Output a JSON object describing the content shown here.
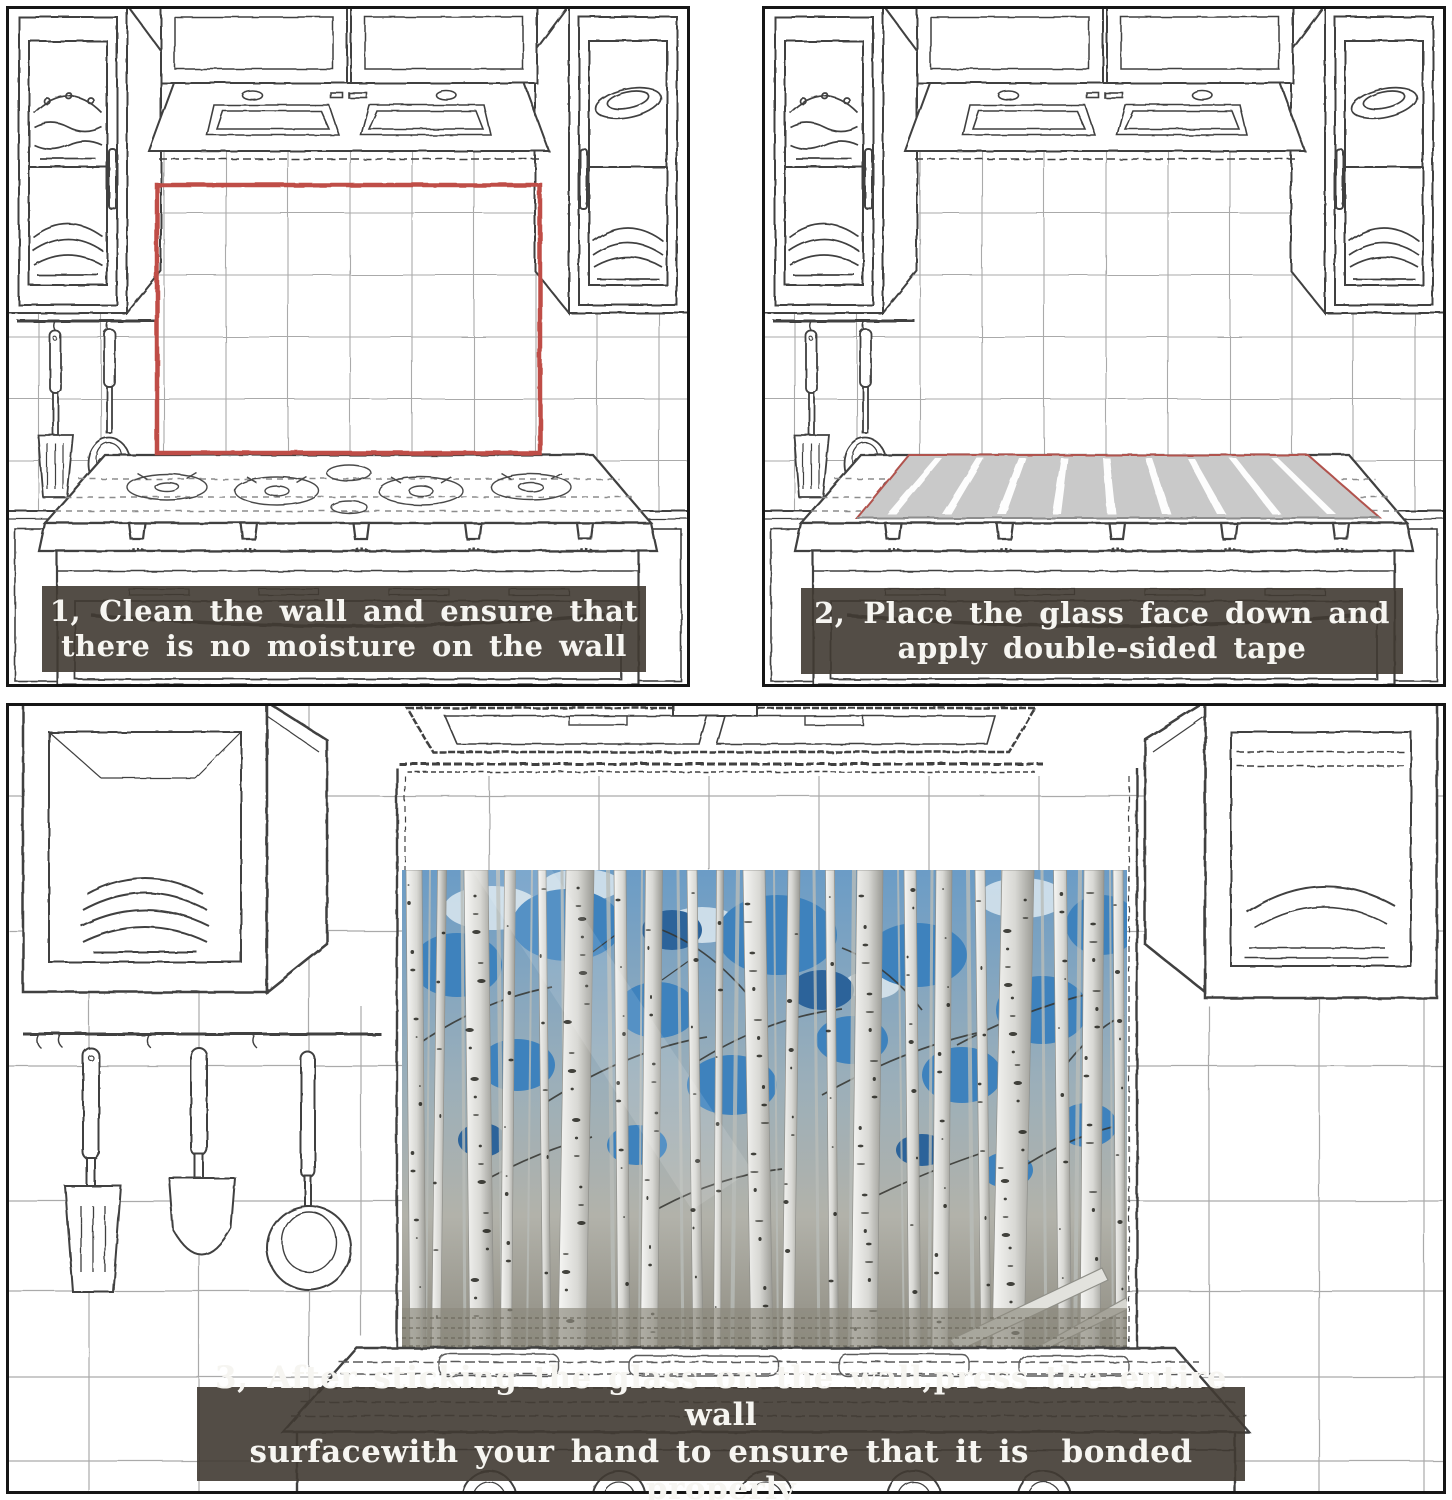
{
  "steps": [
    {
      "prefix": "1、",
      "line1": "Clean the wall and ensure that",
      "line2": "there is no moisture on the wall"
    },
    {
      "prefix": "2、",
      "line1": "Place the glass face down and",
      "line2": "apply double-sided tape"
    },
    {
      "prefix": "3、",
      "line1": "After sticking the glass on the wall,press the entire wall",
      "line2": "surfacewith your hand to ensure that it is  bonded properly"
    }
  ],
  "colors": {
    "marking_outline": "#bf4e47",
    "glass_fill": "#c9c9c9",
    "tape_strips": "#ffffff",
    "overlay_background": "#403a32",
    "overlay_text": "#f6f5f1",
    "forest_sky_blue": "#3e82bd",
    "sketch_line": "#3f3f3f",
    "tile_line": "#a6a6a6",
    "panel_border": "#161616"
  }
}
